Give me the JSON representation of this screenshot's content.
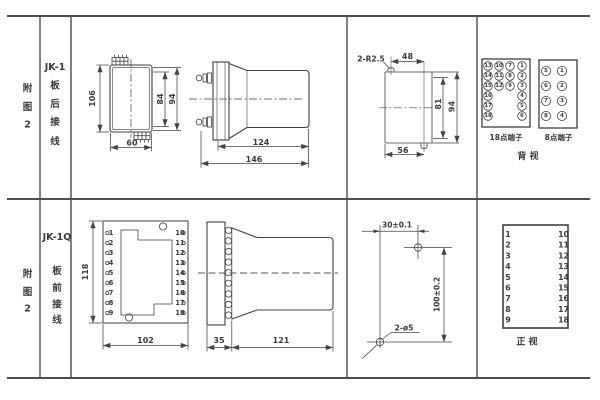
{
  "colors": {
    "ink": "#3f3f3f",
    "paper": "#ffffff"
  },
  "row1": {
    "index_chars": [
      "附",
      "图",
      "2"
    ],
    "title": "JK-1",
    "title_chars": [
      "板",
      "后",
      "接",
      "线"
    ],
    "front_view": {
      "dim_height": "106",
      "dim_width": "60",
      "dim_mid": "84",
      "dim_outer": "94"
    },
    "side_view": {
      "dim_body": "124",
      "dim_total": "146"
    },
    "cutout_view": {
      "slot": "2-R2.5",
      "dim_top": "48",
      "dim_inner": "81",
      "dim_height": "94",
      "dim_width": "56"
    },
    "term18": {
      "label": "18点端子",
      "cells": [
        "13",
        "10",
        "7",
        "1",
        "14",
        "11",
        "8",
        "2",
        "15",
        "12",
        "9",
        "3",
        "16",
        "4",
        "17",
        "5",
        "18",
        "6"
      ]
    },
    "term8": {
      "label": "8点端子",
      "cells": [
        "5",
        "1",
        "6",
        "2",
        "7",
        "3",
        "8",
        "4"
      ]
    },
    "view_label": "背 视"
  },
  "row2": {
    "index_chars": [
      "附",
      "图",
      "2"
    ],
    "title": "JK-1Q",
    "title_chars": [
      "板",
      "前",
      "接",
      "线"
    ],
    "front_view": {
      "dim_height": "118",
      "dim_width": "102",
      "left_pins": [
        "1",
        "2",
        "3",
        "4",
        "5",
        "6",
        "7",
        "8",
        "9"
      ],
      "right_pins": [
        "10",
        "11",
        "12",
        "13",
        "14",
        "15",
        "16",
        "17",
        "18"
      ]
    },
    "side_view": {
      "dim_flange": "35",
      "dim_body": "121"
    },
    "drill_view": {
      "dim_width": "30±0.1",
      "dim_height": "100±0.2",
      "holes": "2-ø5"
    },
    "terminal_table": {
      "left": [
        "1",
        "2",
        "3",
        "4",
        "5",
        "6",
        "7",
        "8",
        "9"
      ],
      "right": [
        "10",
        "11",
        "12",
        "13",
        "14",
        "15",
        "16",
        "17",
        "18"
      ]
    },
    "view_label": "正 视"
  }
}
